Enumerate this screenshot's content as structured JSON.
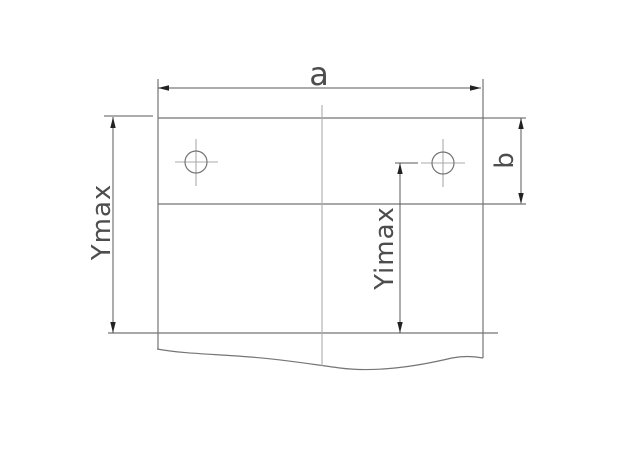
{
  "labels": {
    "a": "a",
    "b": "b",
    "ymax": "Ymax",
    "yimax": "Yimax"
  },
  "colors": {
    "background": "#ffffff",
    "object-line": "#757575",
    "centerline": "#ababab",
    "dimension-line": "#5a5a5a",
    "arrow": "#222222",
    "text": "#4d4d4d"
  }
}
